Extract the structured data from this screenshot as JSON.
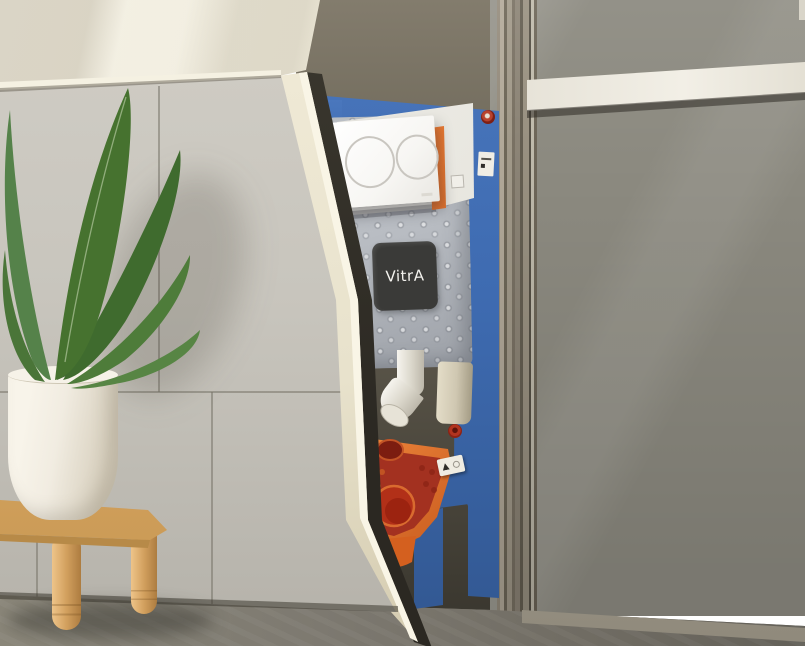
{
  "image_type": "3d product photo",
  "subject": "VitrA concealed WC cistern installation frame revealed behind a diagonally cut wall, with plant and wooden stool",
  "brand": {
    "logo_text": "VitrA"
  },
  "colors": {
    "frame-blue": "#3e6bb1",
    "bracket-orange": "#e06d28",
    "bracket-red": "#a82f1c",
    "cistern": "#b9bdc3",
    "logo-bg": "#3a3a38",
    "plate": "#f7f6f3",
    "tile-wall": "#c8c5bd",
    "cream-wall": "#eae5d3",
    "cut-edge": "#e8e2cc",
    "dark-wall": "#8b897f",
    "floor": "#7e7a71",
    "wood": "#d8a763",
    "pot": "#f1ece1",
    "pipe-beige": "#cfc7b1"
  },
  "elements": [
    "dual-flush actuator plate with two round buttons",
    "grey dimpled cistern with VitrA badge",
    "blue steel mounting frame",
    "orange WC pan bracket with outlet holes",
    "white flush elbow pipe and beige outlet pipe",
    "galvanized wall stud and cross beam",
    "potted plant on wooden stool"
  ]
}
